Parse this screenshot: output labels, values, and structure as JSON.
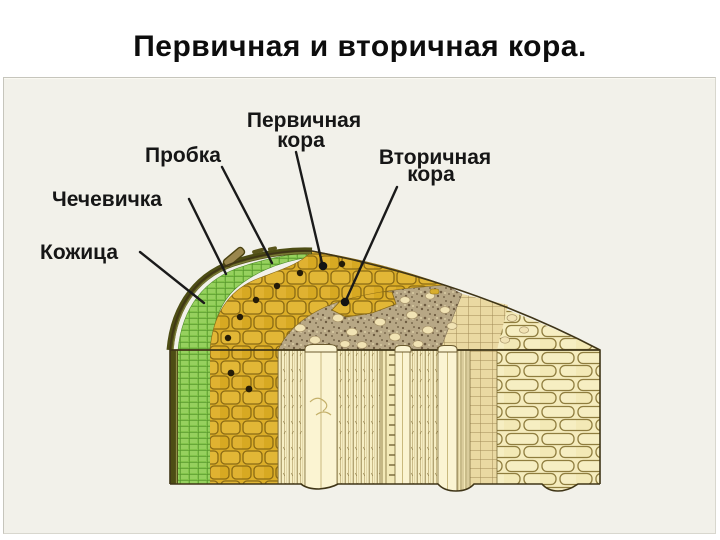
{
  "title": "Первичная и вторичная кора.",
  "slide": {
    "labels": {
      "primary_cortex_line1": "Первичная",
      "primary_cortex_line2": "кора",
      "cork": "Пробка",
      "secondary_cortex_line1": "Вторичная",
      "secondary_cortex_line2": "кора",
      "lenticel": "Чечевичка",
      "epidermis": "Кожица"
    },
    "colors": {
      "panel_bg": "#f2f1ea",
      "epidermis_dark_olive": "#4d4d14",
      "cork_green": "#82c44a",
      "cork_green_line": "#4e8c28",
      "primary_cortex_gold": "#dcae28",
      "primary_cortex_outline": "#8a6a14",
      "secondary_cortex_brown": "#b7a785",
      "secondary_cortex_speckle": "#6e5c41",
      "blob_cream": "#f1e3b4",
      "phloem_stripe_bg": "#f7efc5",
      "stripe_line": "#8c7a46",
      "wood_cell_bg": "#f5ecbd",
      "wood_cell_line": "#8f7d3e",
      "cambium_grid_bg": "#ead9a2",
      "label_text": "#161616",
      "leader_line": "#1a1a1a"
    }
  }
}
